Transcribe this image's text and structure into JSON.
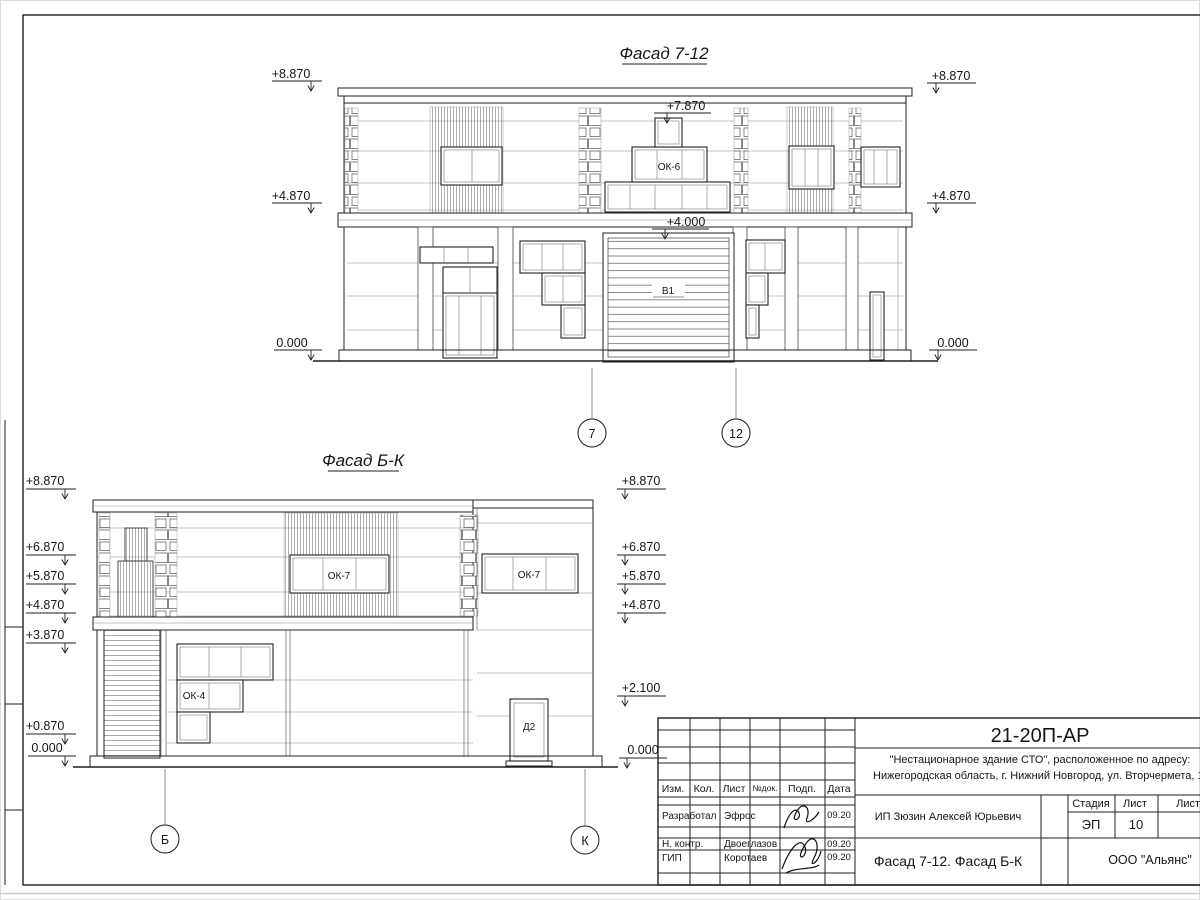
{
  "sheet": {
    "titleblock": {
      "doc_number": "21-20П-АР",
      "project_line1": "\"Нестационарное здание СТО\", расположенное по адресу:",
      "project_line2": "Нижегородская область, г. Нижний Новгород, ул. Вторчермета, 1А",
      "client": "ИП Зюзин Алексей Юрьевич",
      "drawing_title": "Фасад 7-12. Фасад Б-К",
      "company": "ООО \"Альянс\"",
      "stage_label": "Стадия",
      "sheet_label": "Лист",
      "sheets_label": "Листов",
      "stage_value": "ЭП",
      "sheet_value": "10",
      "header_cols": [
        "Изм.",
        "Кол.",
        "Лист",
        "№док.",
        "Подп.",
        "Дата"
      ],
      "roles": [
        {
          "role": "Разработал",
          "name": "Эфрос",
          "date": "09.20"
        },
        {
          "role": "Н. контр.",
          "name": "Двоеглазов",
          "date": "09.20"
        },
        {
          "role": "ГИП",
          "name": "Коротаев",
          "date": "09.20"
        }
      ]
    }
  },
  "facade_top": {
    "title": "Фасад 7-12",
    "marks_left": [
      "+8.870",
      "+4.870",
      "0.000"
    ],
    "marks_right": [
      "+8.870",
      "+4.870",
      "0.000"
    ],
    "marks_inner": [
      "+7.870",
      "+4.000"
    ],
    "window_label": "ОК-6",
    "gate_label": "В1",
    "axes": [
      "7",
      "12"
    ]
  },
  "facade_bottom": {
    "title": "Фасад Б-К",
    "marks_left": [
      "+8.870",
      "+6.870",
      "+5.870",
      "+4.870",
      "+3.870",
      "+0.870",
      "0.000"
    ],
    "marks_right": [
      "+8.870",
      "+6.870",
      "+5.870",
      "+4.870",
      "+2.100",
      "0.000"
    ],
    "window_center_label": "ОК-7",
    "window_right_label": "ОК-7",
    "window_left_label": "ОК-4",
    "door_label": "Д2",
    "axes": [
      "Б",
      "К"
    ]
  }
}
